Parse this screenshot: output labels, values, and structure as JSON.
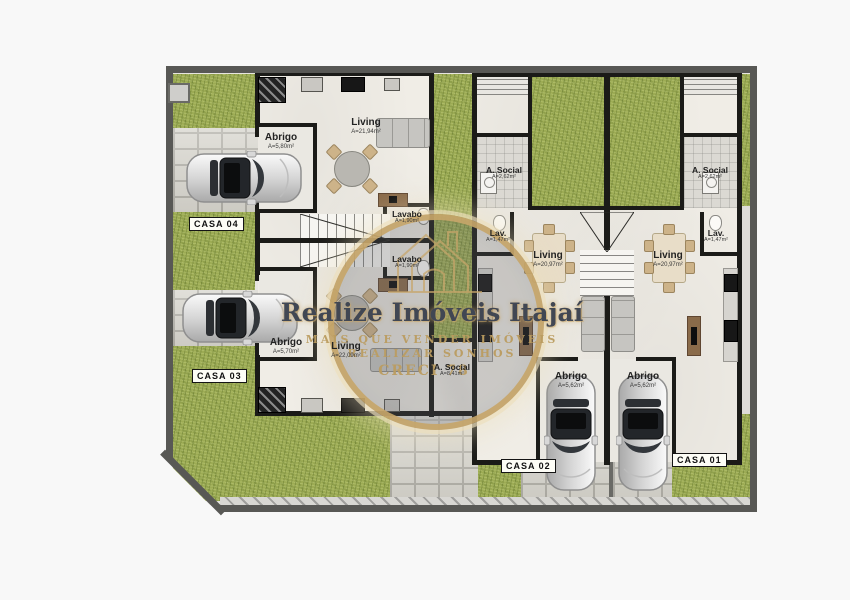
{
  "watermark": {
    "title": "Realize Imóveis Itajaí",
    "tagline_line1": "MAIS QUE VENDER IMÓVEIS",
    "tagline_line2": "REALIZAR SONHOS",
    "creci": "CRECI 78"
  },
  "units": {
    "casa01": {
      "tag": "CASA 01",
      "rooms": {
        "social": {
          "name": "A. Social",
          "area": "A=2,62m²"
        },
        "lav": {
          "name": "Lav.",
          "area": "A=1,47m²"
        },
        "living": {
          "name": "Living",
          "area": "A=20,97m²"
        },
        "abrigo": {
          "name": "Abrigo",
          "area": "A=5,62m²"
        }
      }
    },
    "casa02": {
      "tag": "CASA 02",
      "rooms": {
        "social": {
          "name": "A. Social",
          "area": "A=2,62m²"
        },
        "lav": {
          "name": "Lav.",
          "area": "A=1,47m²"
        },
        "living": {
          "name": "Living",
          "area": "A=20,97m²"
        },
        "abrigo": {
          "name": "Abrigo",
          "area": "A=5,62m²"
        }
      }
    },
    "casa03": {
      "tag": "CASA 03",
      "rooms": {
        "abrigo": {
          "name": "Abrigo",
          "area": "A=5,70m²"
        },
        "living": {
          "name": "Living",
          "area": "A=22,09m²"
        },
        "lavabo": {
          "name": "Lavabo",
          "area": "A=1,90m²"
        },
        "social": {
          "name": "A. Social",
          "area": "A=8,41m²"
        }
      }
    },
    "casa04": {
      "tag": "CASA 04",
      "rooms": {
        "abrigo": {
          "name": "Abrigo",
          "area": "A=5,80m²"
        },
        "living": {
          "name": "Living",
          "area": "A=21,94m²"
        },
        "lavabo": {
          "name": "Lavabo",
          "area": "A=1,90m²"
        }
      }
    }
  }
}
